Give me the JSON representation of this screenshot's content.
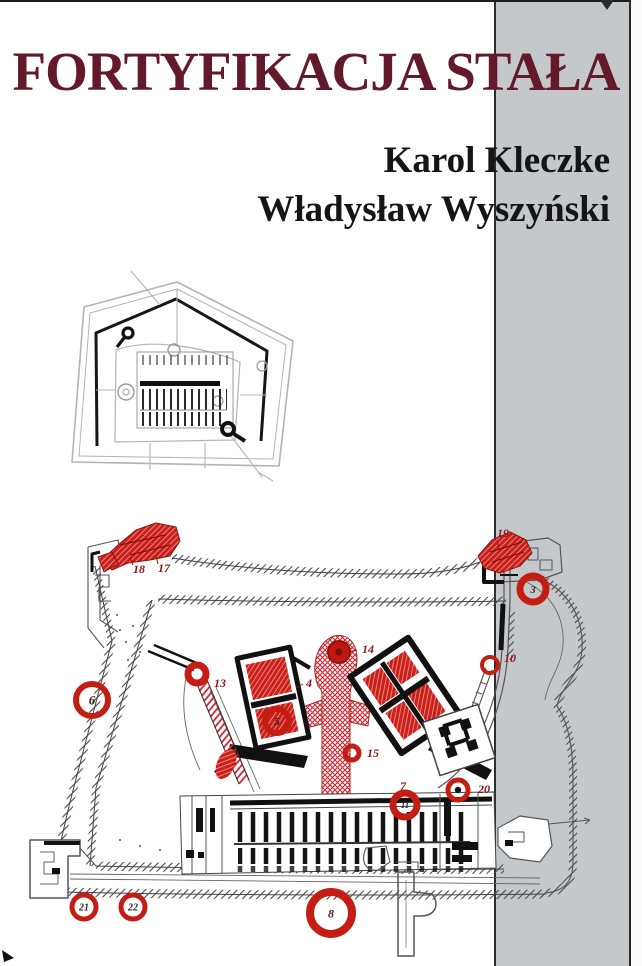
{
  "cover": {
    "title": "FORTYFIKACJA STAŁA",
    "authors": [
      "Karol Kleczke",
      "Władysław Wyszyński"
    ],
    "colors": {
      "title_maroon": "#621a2a",
      "author_black": "#151515",
      "band_gray": "#c5c8ca",
      "marker_red": "#c41d13",
      "plan_dark_line": "#3d3d3d",
      "plan_light_line": "#b4b4b4"
    }
  },
  "large_plan": {
    "numbered_circles": [
      {
        "n": "3",
        "x": 533,
        "y": 589,
        "r": 13,
        "sw": 7,
        "fs": 11
      },
      {
        "n": "6",
        "x": 92,
        "y": 700,
        "r": 16,
        "sw": 6,
        "fs": 13
      },
      {
        "n": "5",
        "x": 277,
        "y": 721,
        "r": 12,
        "sw": 6,
        "fs": 11
      },
      {
        "n": "8",
        "x": 331,
        "y": 913,
        "r": 21,
        "sw": 8,
        "fs": 12
      },
      {
        "n": "11",
        "x": 405,
        "y": 805,
        "r": 12,
        "sw": 7,
        "fs": 9
      },
      {
        "n": "21",
        "x": 84,
        "y": 907,
        "r": 12,
        "sw": 5,
        "fs": 10
      },
      {
        "n": "22",
        "x": 133,
        "y": 907,
        "r": 12,
        "sw": 5,
        "fs": 10
      },
      {
        "n": "",
        "x": 458,
        "y": 790,
        "r": 10,
        "sw": 5,
        "fs": 0,
        "dot": true
      },
      {
        "n": "",
        "x": 490,
        "y": 665,
        "r": 8,
        "sw": 4,
        "fs": 0
      },
      {
        "n": "",
        "x": 197,
        "y": 674,
        "r": 9,
        "sw": 7,
        "fs": 0
      },
      {
        "n": "",
        "x": 352,
        "y": 753,
        "r": 7,
        "sw": 5,
        "fs": 0
      }
    ],
    "point_labels": [
      {
        "t": "18",
        "x": 133,
        "y": 573
      },
      {
        "t": "17",
        "x": 158,
        "y": 572
      },
      {
        "t": "19",
        "x": 497,
        "y": 537
      },
      {
        "t": "14",
        "x": 362,
        "y": 653
      },
      {
        "t": "4",
        "x": 306,
        "y": 687
      },
      {
        "t": "13",
        "x": 214,
        "y": 687
      },
      {
        "t": "10",
        "x": 504,
        "y": 662
      },
      {
        "t": "15",
        "x": 367,
        "y": 757
      },
      {
        "t": "7",
        "x": 400,
        "y": 790
      },
      {
        "t": "20",
        "x": 478,
        "y": 793
      }
    ]
  }
}
